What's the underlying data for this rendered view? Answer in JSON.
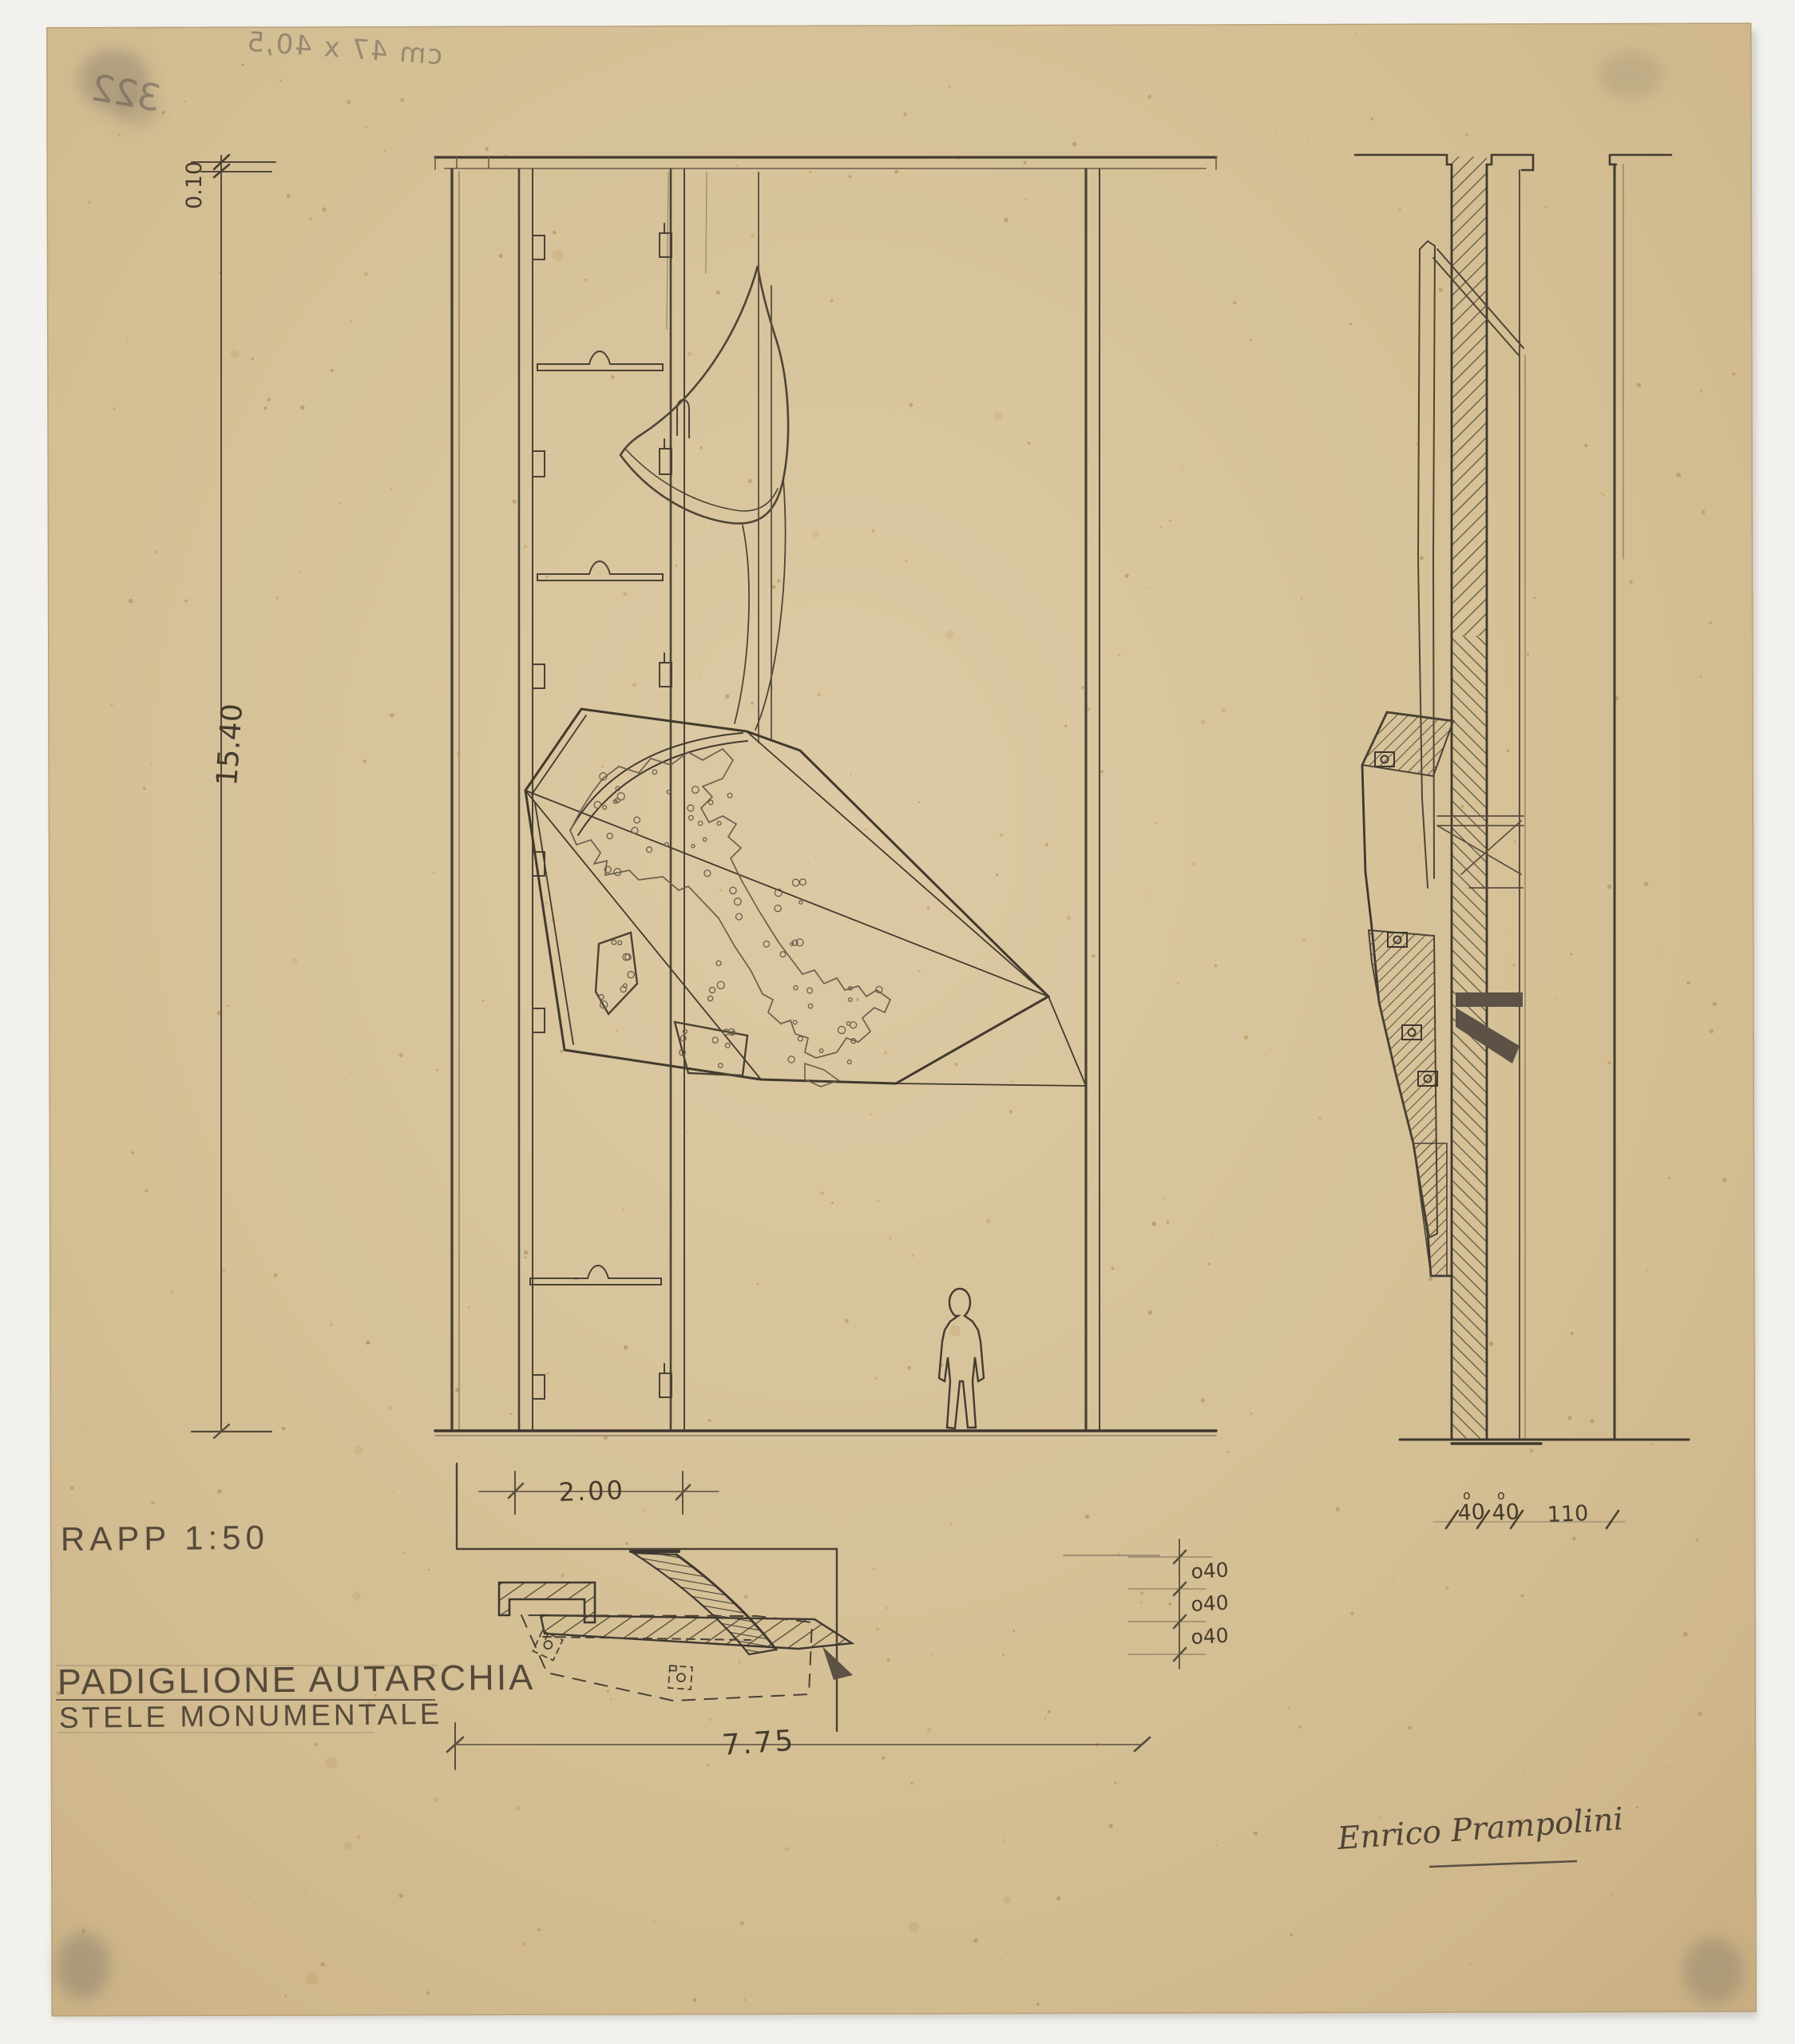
{
  "sheet": {
    "verso_size_note": "cm 47 x 40,5",
    "verso_number": "322"
  },
  "labels": {
    "scale": "RAPP 1:50",
    "title": "PADIGLIONE AUTARCHIA",
    "subtitle": "STELE MONUMENTALE",
    "signature": "Enrico Prampolini"
  },
  "dimensions": {
    "total_height": "15.40",
    "top_detail": "0.10",
    "bay_width": "2.00",
    "total_width": "7.75",
    "zero_mark": "o",
    "plan_offsets": [
      "o40",
      "o40",
      "o40"
    ],
    "base_segments": [
      "40",
      "40",
      "110"
    ]
  },
  "colors": {
    "paper": "#d5c096",
    "paper_edge": "#c8ae82",
    "pencil_dark": "#3f3830",
    "pencil": "#57503f",
    "pencil_faint": "#8d7d66",
    "backdrop": "#f2f1ed"
  }
}
